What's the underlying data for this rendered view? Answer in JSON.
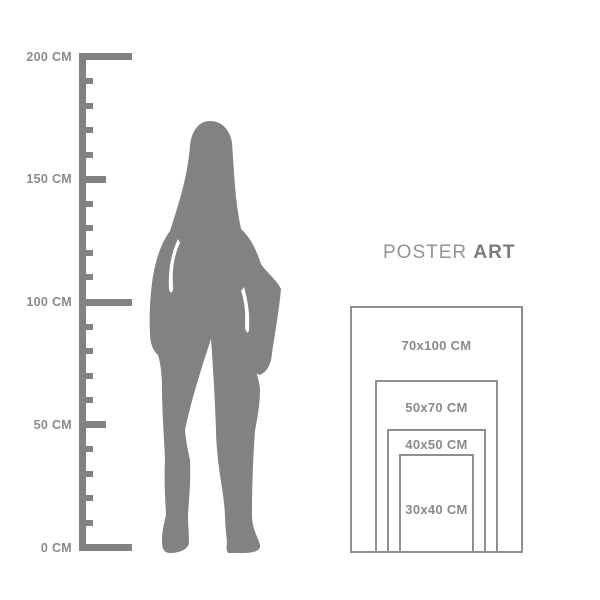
{
  "colors": {
    "background": "#ffffff",
    "graphic": "#828282",
    "label": "#8a8a8a",
    "line": "#8f8f8f",
    "title_regular": "#939393",
    "title_bold": "#7a7a7a"
  },
  "ruler": {
    "unit": "CM",
    "max_value": 200,
    "minor_step": 10,
    "medium_step": 50,
    "major_ticks": [
      {
        "value": 200,
        "label": "200 CM"
      },
      {
        "value": 150,
        "label": "150 CM"
      },
      {
        "value": 100,
        "label": "100 CM"
      },
      {
        "value": 50,
        "label": "50 CM"
      },
      {
        "value": 0,
        "label": "0 CM"
      }
    ]
  },
  "figure": {
    "name": "standing-woman-silhouette"
  },
  "poster_guide": {
    "title": {
      "regular": "POSTER",
      "bold": "ART"
    },
    "sizes": [
      {
        "label": "70x100 CM",
        "width_cm": 70,
        "height_cm": 100
      },
      {
        "label": "50x70 CM",
        "width_cm": 50,
        "height_cm": 70
      },
      {
        "label": "40x50 CM",
        "width_cm": 40,
        "height_cm": 50
      },
      {
        "label": "30x40 CM",
        "width_cm": 30,
        "height_cm": 40
      }
    ]
  }
}
